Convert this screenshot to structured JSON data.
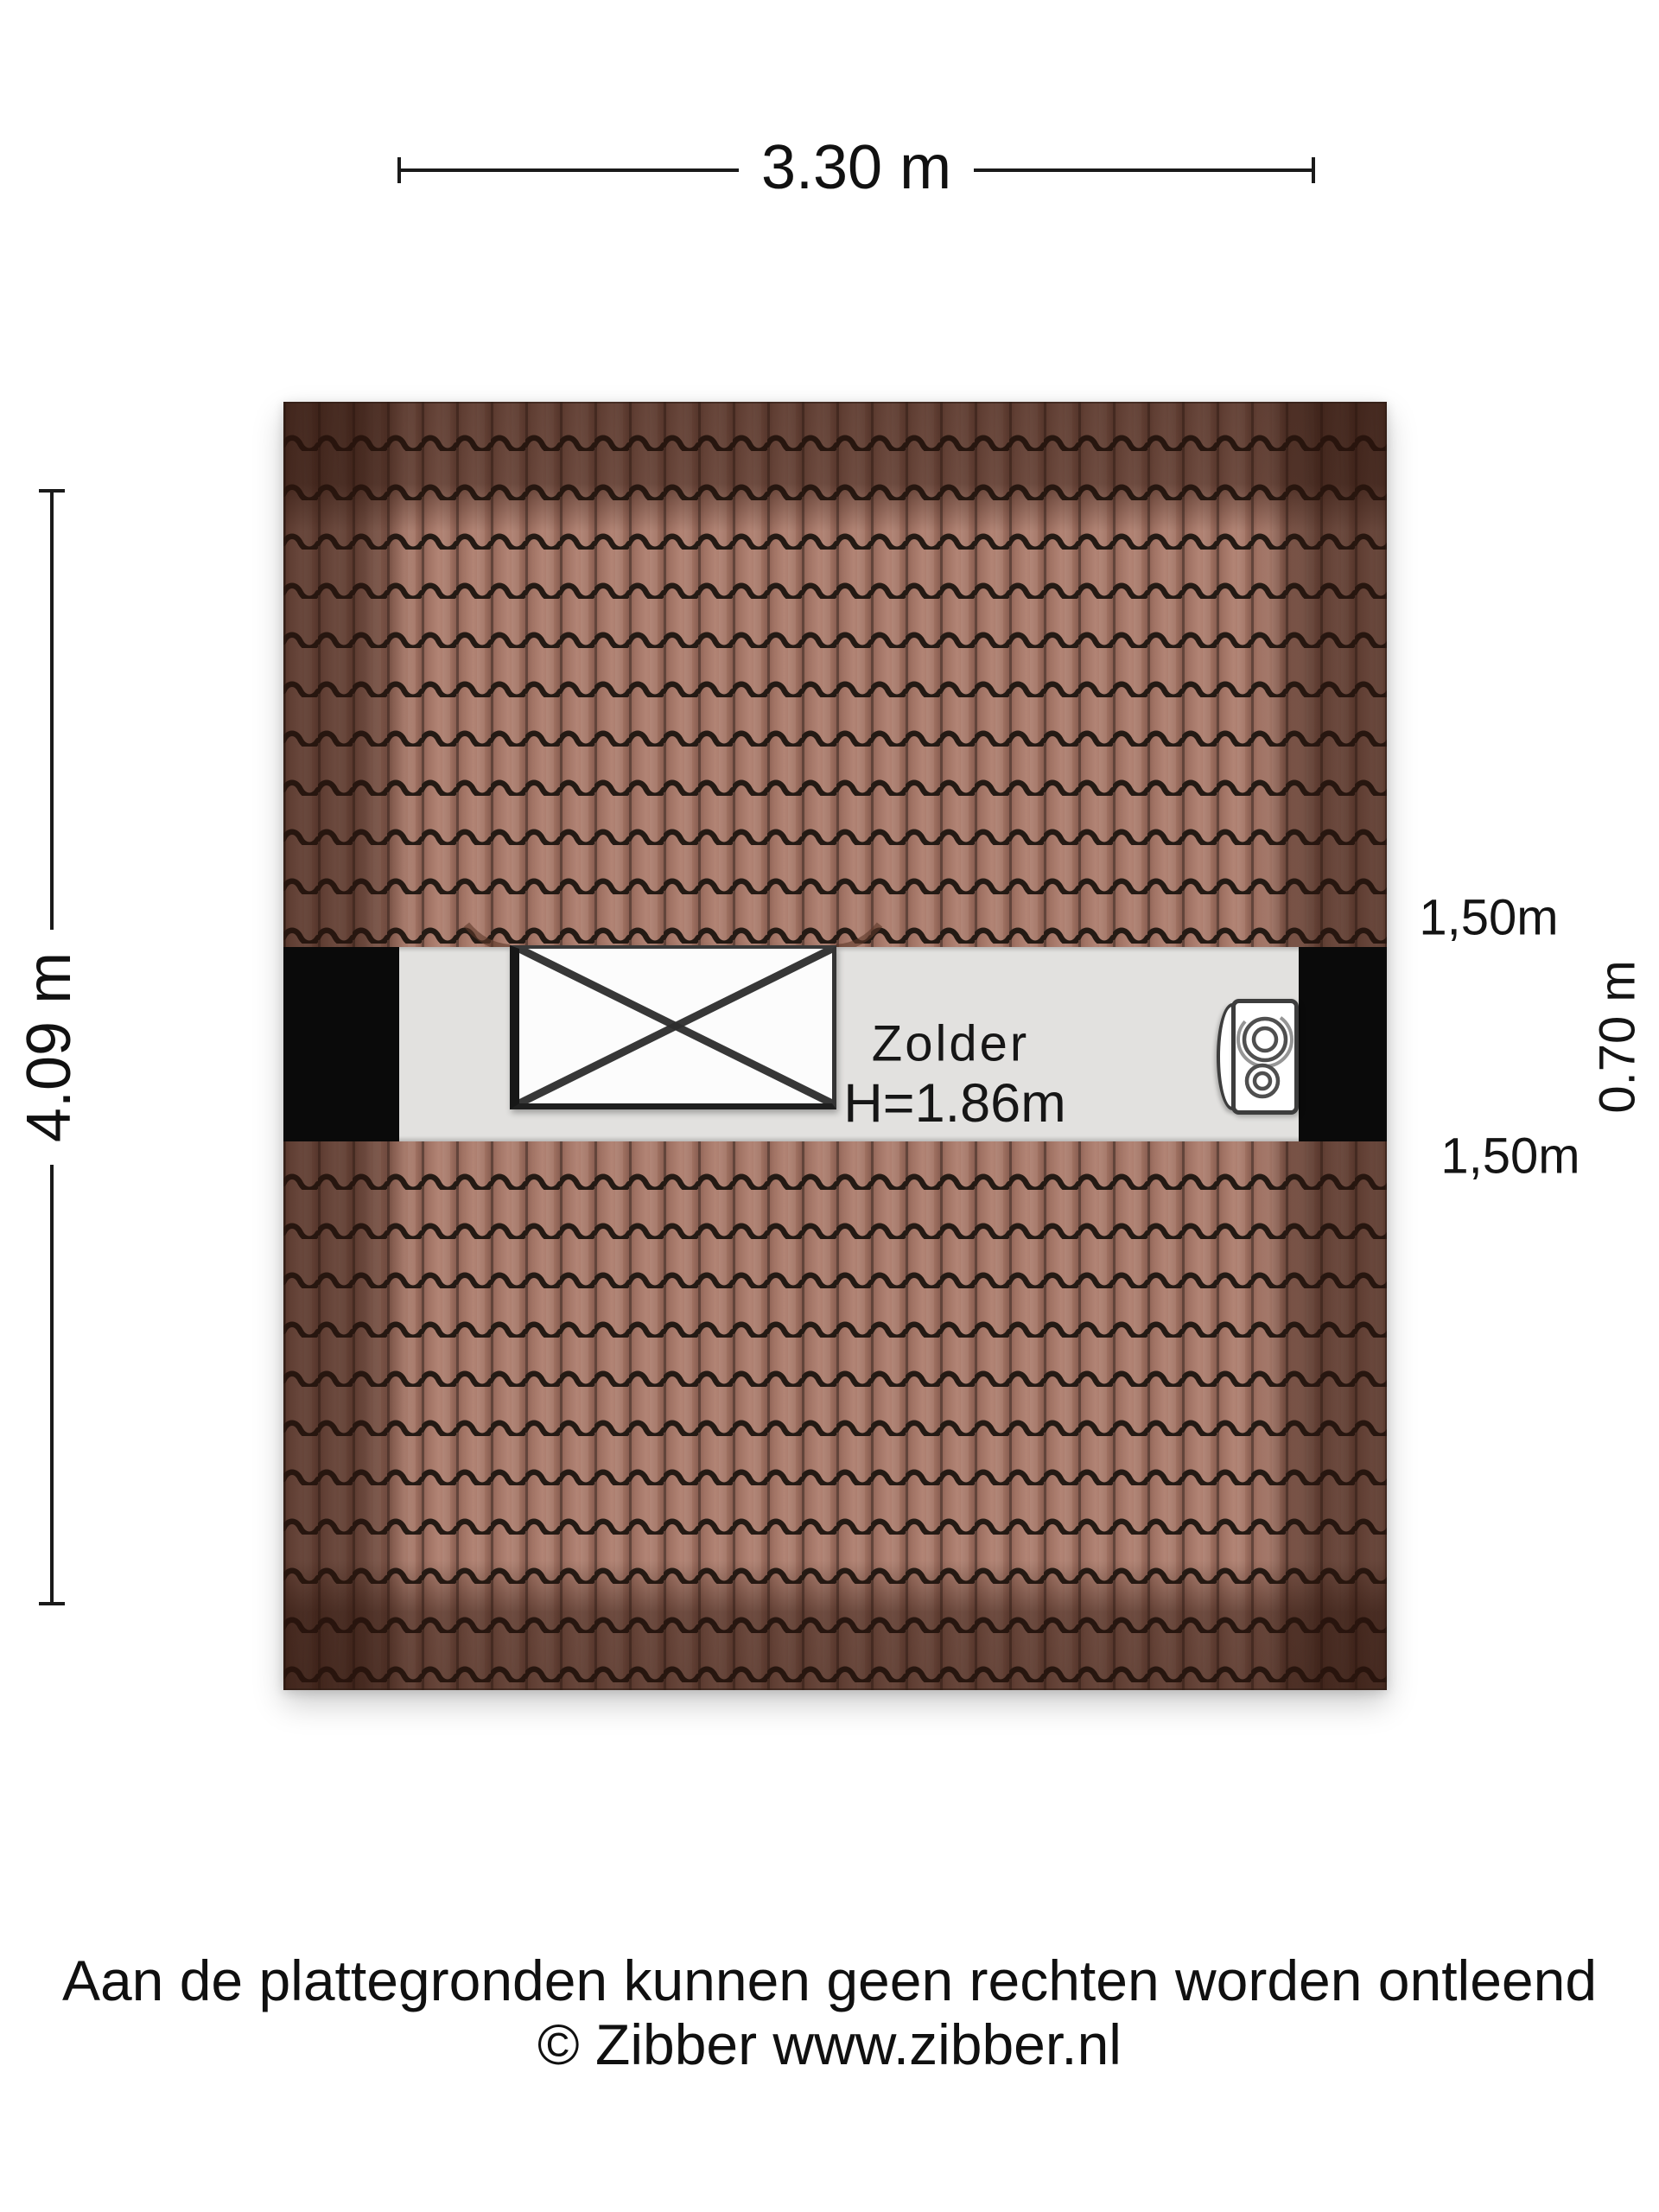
{
  "floorplan": {
    "dimensions": {
      "width_label": "3.30 m",
      "height_label": "4.09 m"
    },
    "side_labels": {
      "top": "1,50m",
      "middle": "0.70 m",
      "bottom": "1,50m"
    },
    "room": {
      "name": "Zolder",
      "ceiling_height": "H=1.86m"
    },
    "colors": {
      "roof_tile_base": "#a3766a",
      "roof_tile_dark_border": "#5f4136",
      "roof_tile_groove": "#241a14",
      "attic_floor": "#e2e1df",
      "wall": "#0a0a0a",
      "text": "#111111"
    }
  },
  "footer": {
    "disclaimer": "Aan de plattegronden kunnen geen rechten worden ontleend",
    "copyright": "© Zibber www.zibber.nl"
  }
}
